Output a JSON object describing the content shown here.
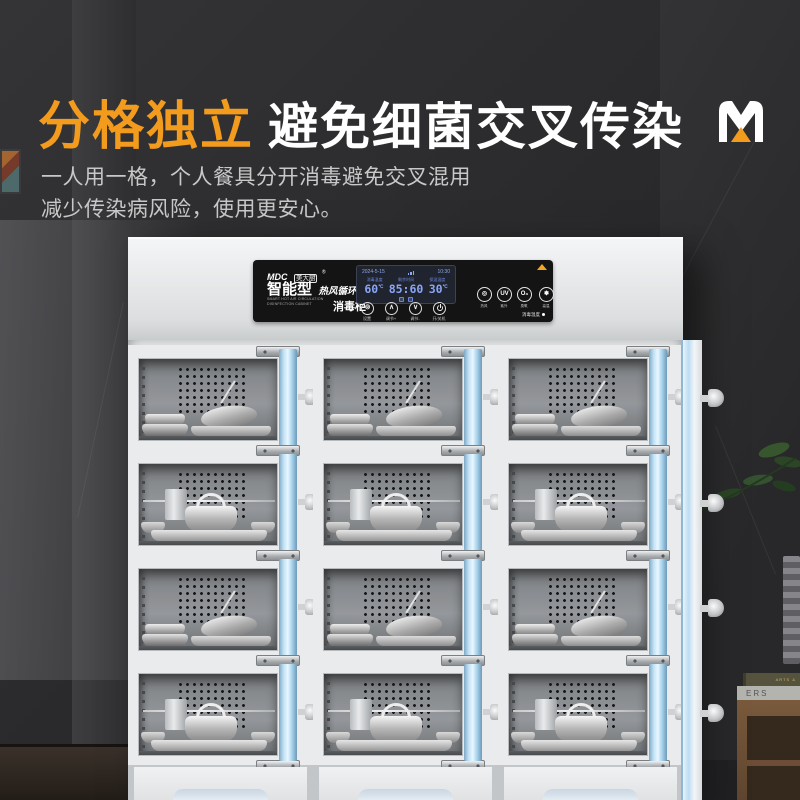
{
  "header": {
    "title_highlight": "分格独立",
    "title_rest": "避免细菌交叉传染",
    "subtitle_line1": "一人用一格，个人餐具分开消毒避免交叉混用",
    "subtitle_line2": "减少传染病风险，使用更安心。"
  },
  "colors": {
    "accent_orange": "#F39B1D",
    "door_blue": "#BFE0F4",
    "display_blue": "#8AA6F5",
    "cabinet_body": "#E9EBEC",
    "panel_black": "#141414"
  },
  "control_panel": {
    "brand": "MDC",
    "brand_cn": "美大厨",
    "reg_mark": "®",
    "model_type": "智能型",
    "model_feature": "热风循环",
    "model_en": "SMART HOT AIR CIRCULATION DISINFECTION CABINET",
    "product_name": "消毒柜",
    "display": {
      "date": "2024-5-15",
      "time": "10:30",
      "labels": [
        "消毒温度",
        "剩余时间",
        "保温温度"
      ],
      "values": [
        {
          "num": "60",
          "unit": "℃"
        },
        {
          "num": "85:60",
          "unit": ""
        },
        {
          "num": "30",
          "unit": "℃"
        }
      ]
    },
    "buttons": [
      {
        "glyph": "⊚",
        "label": "设置"
      },
      {
        "glyph": "∧",
        "label": "调节+"
      },
      {
        "glyph": "∨",
        "label": "调节-"
      },
      {
        "glyph": "",
        "label": "开/关机"
      }
    ],
    "functions": [
      {
        "glyph": "◎",
        "label": "热风"
      },
      {
        "glyph": "UV",
        "label": "紫外"
      },
      {
        "glyph": "O₃",
        "label": "臭氧"
      },
      {
        "glyph": "✽",
        "label": "高温"
      }
    ],
    "status_text": "消毒温度"
  },
  "cabinet": {
    "columns": 3,
    "rows": [
      {
        "scene": "bowls"
      },
      {
        "scene": "pot"
      },
      {
        "scene": "bowls"
      },
      {
        "scene": "pot"
      }
    ]
  },
  "scene": {
    "book_top_label": "ARTS &",
    "book_bottom_label": "ERS"
  }
}
